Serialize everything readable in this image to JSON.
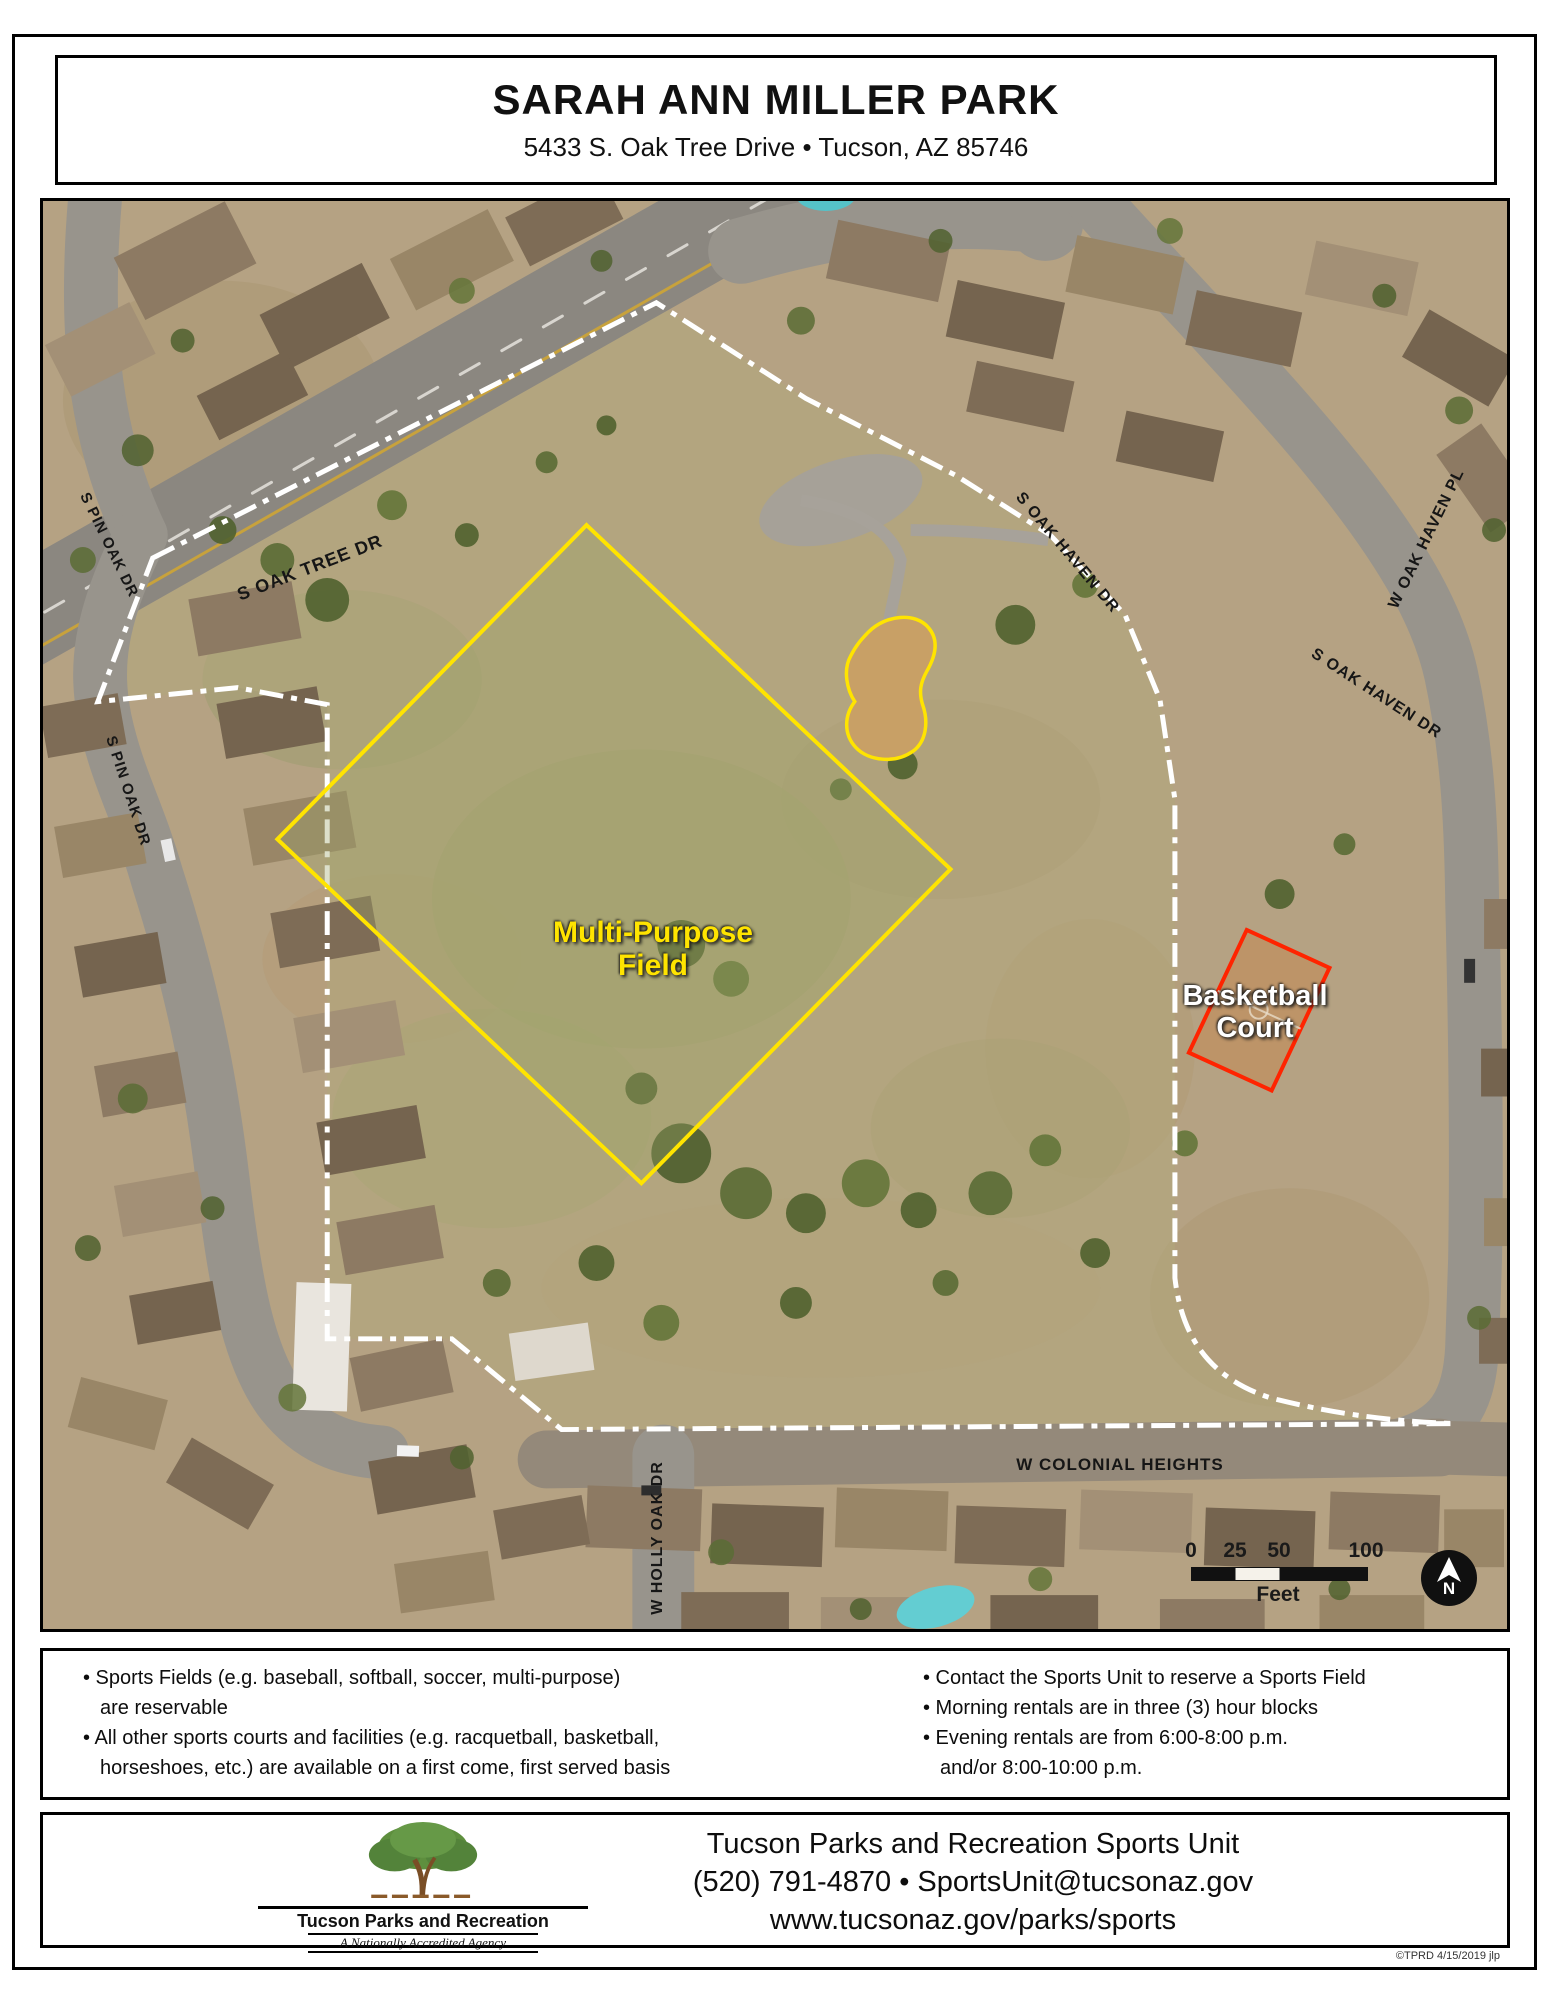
{
  "header": {
    "title": "SARAH ANN MILLER PARK",
    "address": "5433 S. Oak Tree Drive • Tucson, AZ 85746"
  },
  "map": {
    "labels": {
      "field1": "Multi-Purpose",
      "field2": "Field",
      "court1": "Basketball",
      "court2": "Court"
    },
    "streets": [
      "S PIN OAK DR",
      "S OAK TREE DR",
      "W OAK HAVEN PL",
      "S OAK HAVEN DR",
      "S OAK HAVEN DR",
      "S PIN OAK DR",
      "W COLONIAL HEIGHTS",
      "W HOLLY OAK DR"
    ],
    "scale": {
      "ticks": [
        "0",
        "25",
        "50",
        "100"
      ],
      "unit": "Feet"
    },
    "north": "N",
    "colors": {
      "field_outline": "#ffe400",
      "court_outline": "#ff2400",
      "boundary": "#ffffff"
    }
  },
  "info": {
    "left": [
      "• Sports Fields (e.g. baseball, softball, soccer, multi-purpose)",
      "are reservable",
      "• All other sports courts and facilities (e.g. racquetball, basketball,",
      "horseshoes, etc.) are available on a first come, first served basis"
    ],
    "right": [
      "• Contact the Sports Unit to reserve a Sports Field",
      "• Morning rentals are in three (3) hour blocks",
      "• Evening rentals are from 6:00-8:00 p.m.",
      "and/or 8:00-10:00 p.m."
    ]
  },
  "footer": {
    "logo_name": "Tucson Parks and Recreation",
    "logo_tag": "A Nationally Accredited Agency",
    "org": "Tucson Parks and Recreation Sports Unit",
    "phone_email": "(520) 791-4870 • SportsUnit@tucsonaz.gov",
    "url": "www.tucsonaz.gov/parks/sports",
    "credit": "©TPRD 4/15/2019 jlp"
  }
}
